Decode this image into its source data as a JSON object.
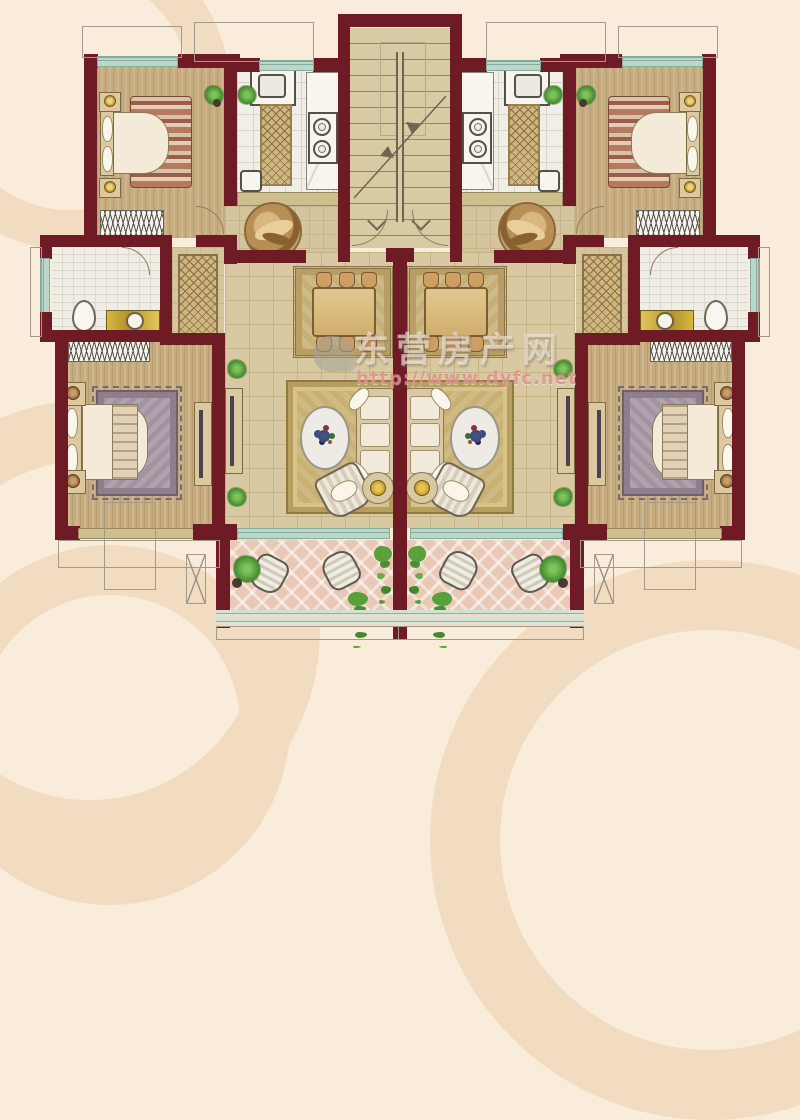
{
  "watermark": {
    "site_name": "东营房产网",
    "url": "http://www.dyfc.net"
  },
  "palette": {
    "wall": "#6e1b26",
    "background": "#f9ecdb",
    "swirl": "#f2dcc1",
    "window": "#b9d8ca",
    "window-line": "#86ab9a",
    "floor-wood": "#c5ab7d",
    "floor-living": "#d8c9a2",
    "floor-kitchen": "#f0eee6",
    "floor-bath": "#efede5",
    "floor-foyer": "#d4c59c",
    "balcony-tile": "#e9c9b6",
    "rug-gold": "#c9b172",
    "furniture-tan": "#dcc9a0",
    "plant-green": "#3f8a2c",
    "watermark-text": "rgba(240,234,222,0.65)",
    "watermark-url": "rgba(215,125,125,0.7)"
  }
}
